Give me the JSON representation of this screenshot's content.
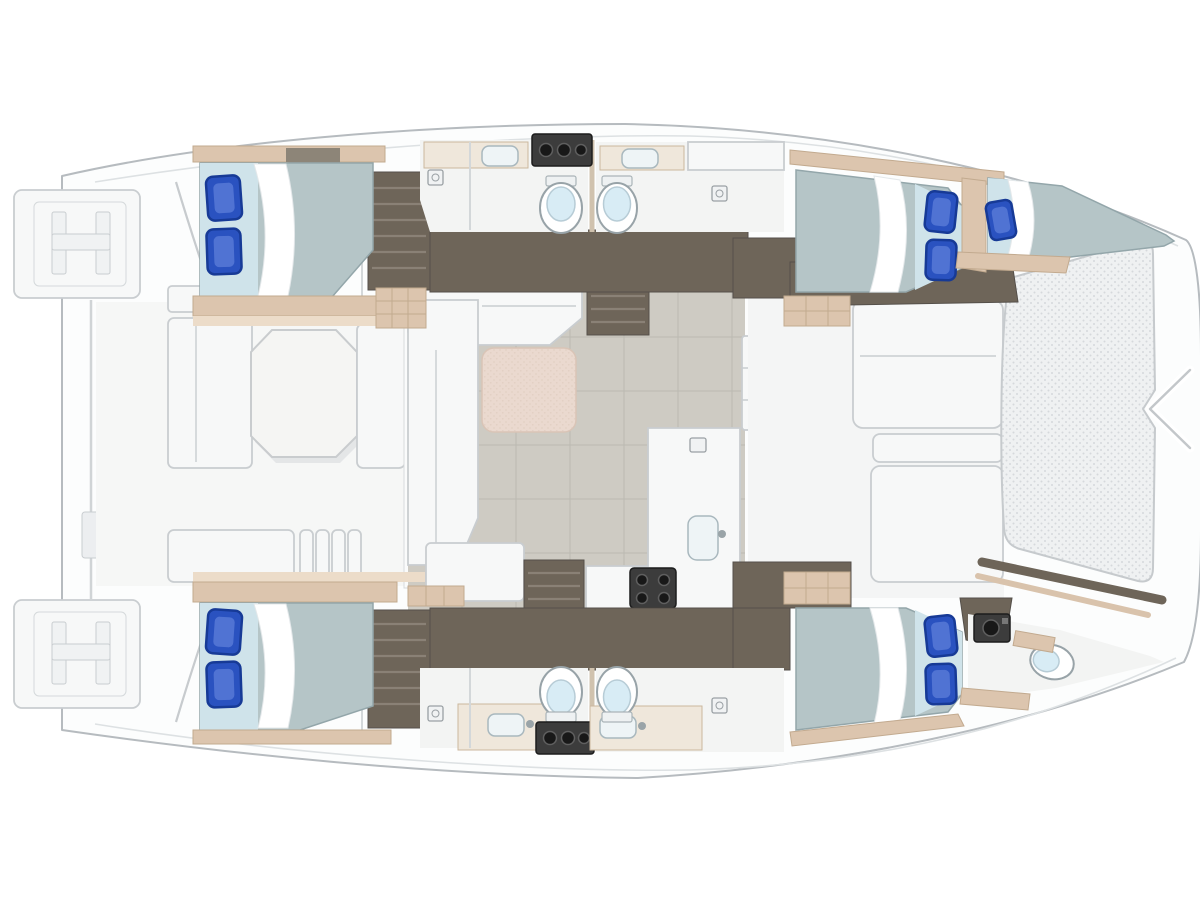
{
  "meta": {
    "title": "Catamaran yacht deck plan",
    "description": "Top-down interior floor plan of a four-cabin sailing catamaran, bow pointing right; no text labels appear on the drawing",
    "view": "top-down deck plan",
    "text_on_image": "none"
  },
  "palette": {
    "background": "#ffffff",
    "hull_fill": "#fcfdfd",
    "hull_line": "#b6bbbf",
    "corridor_dark": "#6e6559",
    "step_light": "#8a8176",
    "tan_trim": "#dcc5ae",
    "tan_dark": "#c2aa8f",
    "mattress": "#b5c5c7",
    "mattress_light": "#cfe3ea",
    "sheet_white": "#ffffff",
    "pillow_blue": "#2a52c0",
    "pillow_dark": "#173a96",
    "floor_gray": "#cecbc3",
    "floor_line": "#bcb9b1",
    "furniture_white": "#f7f8f8",
    "furniture_line": "#c9cdd0",
    "table_beige": "#ead9cf",
    "tramp_fill": "#eff1f2",
    "tramp_dot": "#d5d9dc",
    "fixture_dark": "#3c3c3c",
    "toilet_lid": "#d8ecf5",
    "sink_fill": "#eef4f6"
  },
  "inventory": {
    "cabins": [
      {
        "name": "aft-port-cabin",
        "position": "top-left",
        "bed": "double",
        "pillows": 2
      },
      {
        "name": "forward-port-cabin",
        "position": "top-right",
        "bed": "double",
        "pillows": 2
      },
      {
        "name": "port-forepeak-berth",
        "position": "top bow",
        "bed": "single",
        "pillows": 1
      },
      {
        "name": "aft-starboard-cabin",
        "position": "bottom-left",
        "bed": "double",
        "pillows": 2
      },
      {
        "name": "forward-starboard-cabin",
        "position": "bottom-right",
        "bed": "double",
        "pillows": 2
      }
    ],
    "heads": [
      {
        "name": "port-aft-head",
        "fixtures": [
          "toilet",
          "sink",
          "shower"
        ]
      },
      {
        "name": "port-forward-head",
        "fixtures": [
          "toilet",
          "sink",
          "shower"
        ]
      },
      {
        "name": "starboard-aft-head",
        "fixtures": [
          "toilet",
          "sink",
          "shower"
        ]
      },
      {
        "name": "starboard-forward-head",
        "fixtures": [
          "toilet",
          "sink",
          "shower"
        ]
      },
      {
        "name": "starboard-bow-head",
        "fixtures": [
          "toilet",
          "sink"
        ]
      }
    ],
    "shared_spaces": [
      {
        "name": "salon",
        "features": [
          "l-shaped-sofa",
          "dining-table",
          "companionway-steps"
        ]
      },
      {
        "name": "galley",
        "features": [
          "l-shaped-counter",
          "sink",
          "four-burner-stove"
        ]
      },
      {
        "name": "aft-cockpit",
        "features": [
          "octagonal-table",
          "bench-seating",
          "louvered-steps"
        ]
      },
      {
        "name": "forward-cockpit",
        "features": [
          "bench-seating"
        ]
      },
      {
        "name": "trampoline",
        "features": [
          "netting",
          "bow-bridle"
        ]
      },
      {
        "name": "stern",
        "features": [
          "twin-swim-platforms",
          "transom-steps",
          "davit-bar"
        ]
      }
    ]
  }
}
